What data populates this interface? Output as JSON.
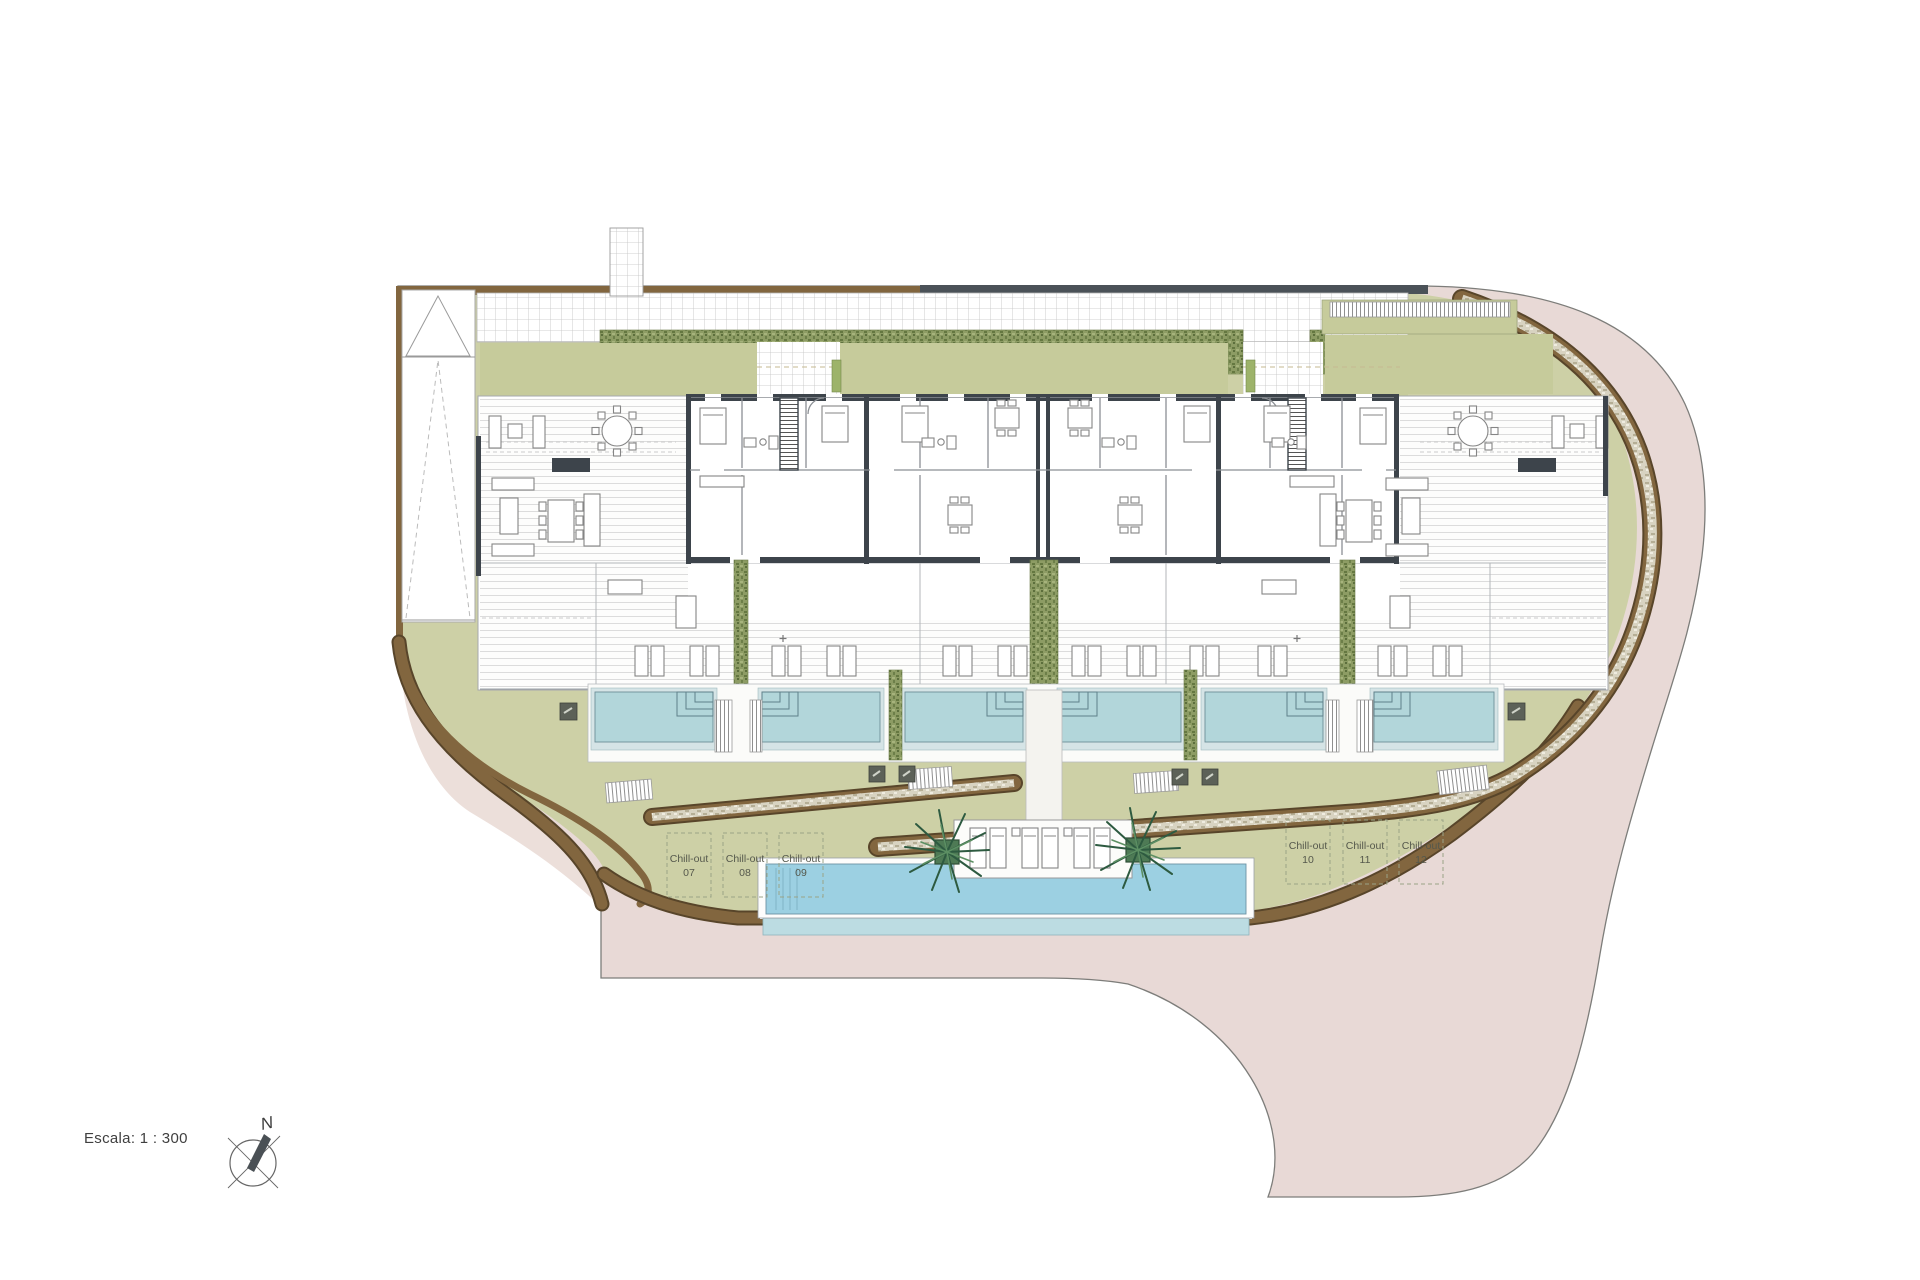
{
  "plan": {
    "scale_label": "Escala: 1 : 300",
    "north_label": "N"
  },
  "chill_out": {
    "label": "Chill-out",
    "items": [
      "07",
      "08",
      "09",
      "10",
      "11",
      "12"
    ]
  },
  "colors": {
    "pink": "#e8d9d6",
    "pink_pale": "#ecdfda",
    "green": "#cdd0a6",
    "olive": "#c6cb9b",
    "hedgegreen": "#8d9c64",
    "brown": "#82663f",
    "brown_dark": "#58452a",
    "wall": "#3d444b",
    "water_private": "#b2d6da",
    "water_main": "#9cd0e2",
    "gravelcol": "#d8d3c1",
    "palm": "#2d5a40",
    "text": "#4a4a4a"
  }
}
